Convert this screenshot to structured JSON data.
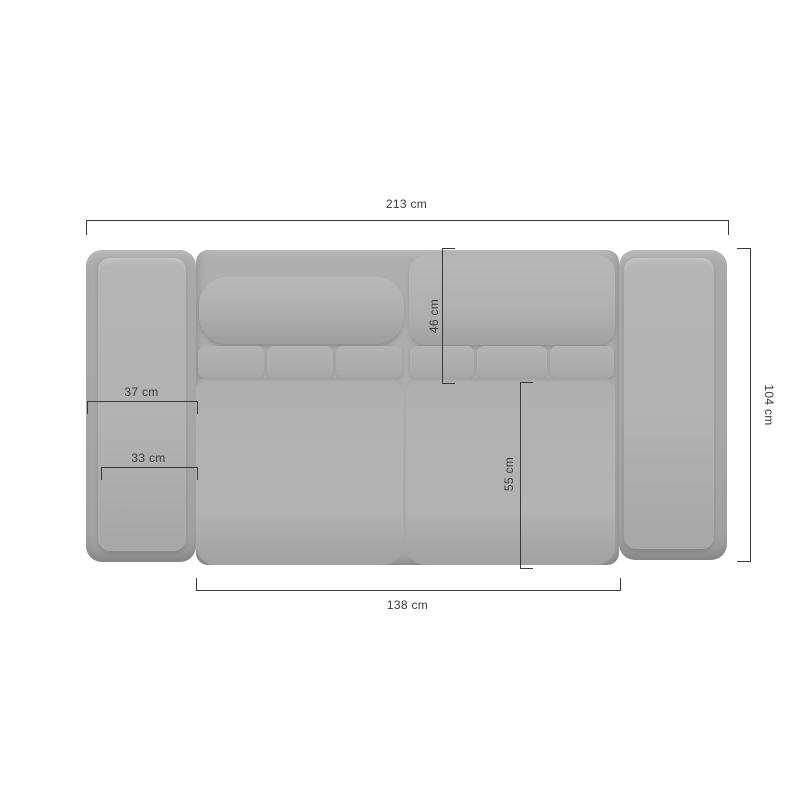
{
  "canvas": {
    "width": 800,
    "height": 800,
    "background": "#ffffff"
  },
  "colors": {
    "dimension_line": "#3a3a3a",
    "dimension_text": "#3a3a3a",
    "sofa_base": "#adadad",
    "sofa_cushion_light": "#b4b4b4",
    "sofa_shadow_edge": "#9d9d9d"
  },
  "measurements": {
    "overall_width": {
      "label": "213 cm",
      "orientation": "horizontal",
      "position": "top"
    },
    "overall_depth": {
      "label": "104 cm",
      "orientation": "vertical",
      "position": "right"
    },
    "seat_width": {
      "label": "138 cm",
      "orientation": "horizontal",
      "position": "bottom"
    },
    "backrest_depth": {
      "label": "46 cm",
      "orientation": "vertical",
      "position": "inner-top"
    },
    "seat_depth": {
      "label": "55 cm",
      "orientation": "vertical",
      "position": "inner-middle"
    },
    "armrest_width": {
      "label": "37 cm",
      "orientation": "horizontal",
      "position": "left-armrest"
    },
    "armrest_cushion_width": {
      "label": "33 cm",
      "orientation": "horizontal",
      "position": "left-armrest-lower"
    }
  }
}
